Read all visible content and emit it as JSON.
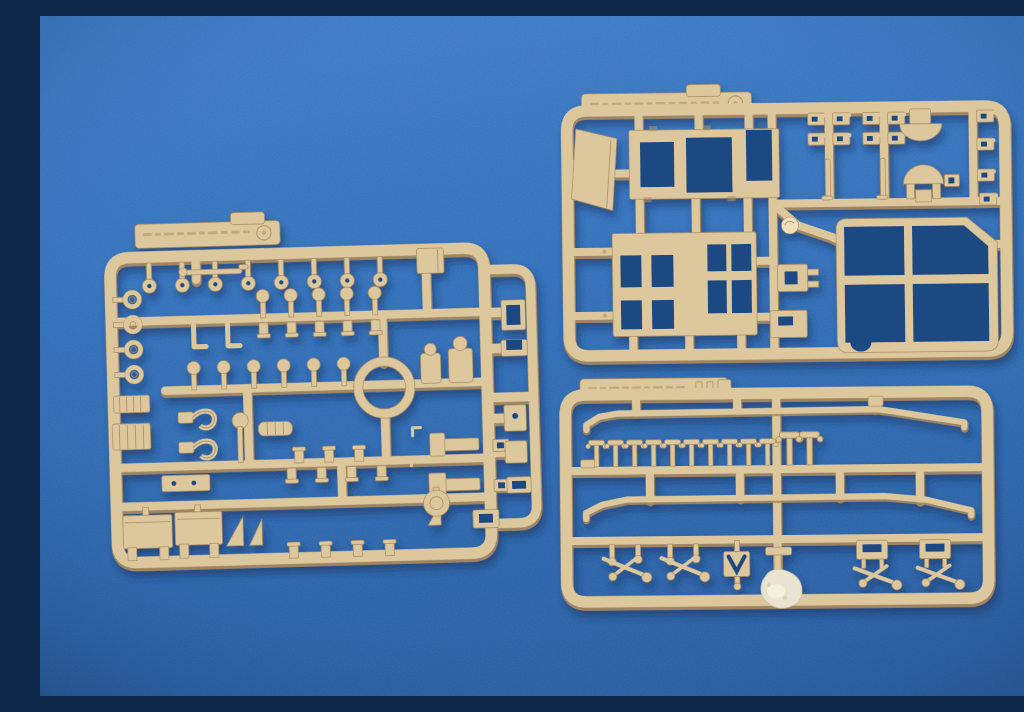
{
  "meta": {
    "type": "photograph",
    "description": "Photo of three tan injection-moulded plastic model-kit sprues (part frames) laid on a blue flocked backdrop"
  },
  "colors": {
    "bg_top": "#3d7cc9",
    "bg_mid": "#2f6fba",
    "bg_bottom": "#265ea4",
    "hole": "#1c4a82",
    "plastic": "#ddc89e",
    "plastic_light": "#eee0bf",
    "plastic_dark": "#a8895e",
    "residue": "#eae3d0",
    "shadow": "#0c2a52"
  },
  "sprues": {
    "left": {
      "name": "detail-parts sprue",
      "label_tab": {
        "embossed_text": "illegible raised scale text",
        "mark": "circled letter"
      },
      "notable_parts": [
        "row of round-head pins",
        "four towing eyelets",
        "large circular ring",
        "two ribbed engine blocks",
        "two J-hooks",
        "two rectangular box panels",
        "two triangular gussets",
        "side column of small brackets"
      ]
    },
    "top_right": {
      "name": "body-panels sprue",
      "label_tab": {
        "embossed_text": "illegible raised scale text",
        "mark": "circled letter"
      },
      "notable_parts": [
        "slanted door panel",
        "upper cab panel with window cut-outs",
        "lower wall frame with paired window grids",
        "large window frame with cross mullions and clipped corner",
        "two dome parts",
        "columns of small clips",
        "round mould swirl"
      ]
    },
    "bottom_right": {
      "name": "handrails-and-fittings sprue",
      "label_tab": {
        "embossed_text": "illegible raised scale text",
        "mark": "three tick tabs"
      },
      "stanchion_count": 10,
      "notable_parts": [
        "two long bent handrails",
        "row of ten T-stanchions",
        "two large stanchions at centre",
        "four brake-lever assemblies",
        "V-notched bracket",
        "white adhesive blob at bottom centre"
      ]
    }
  }
}
